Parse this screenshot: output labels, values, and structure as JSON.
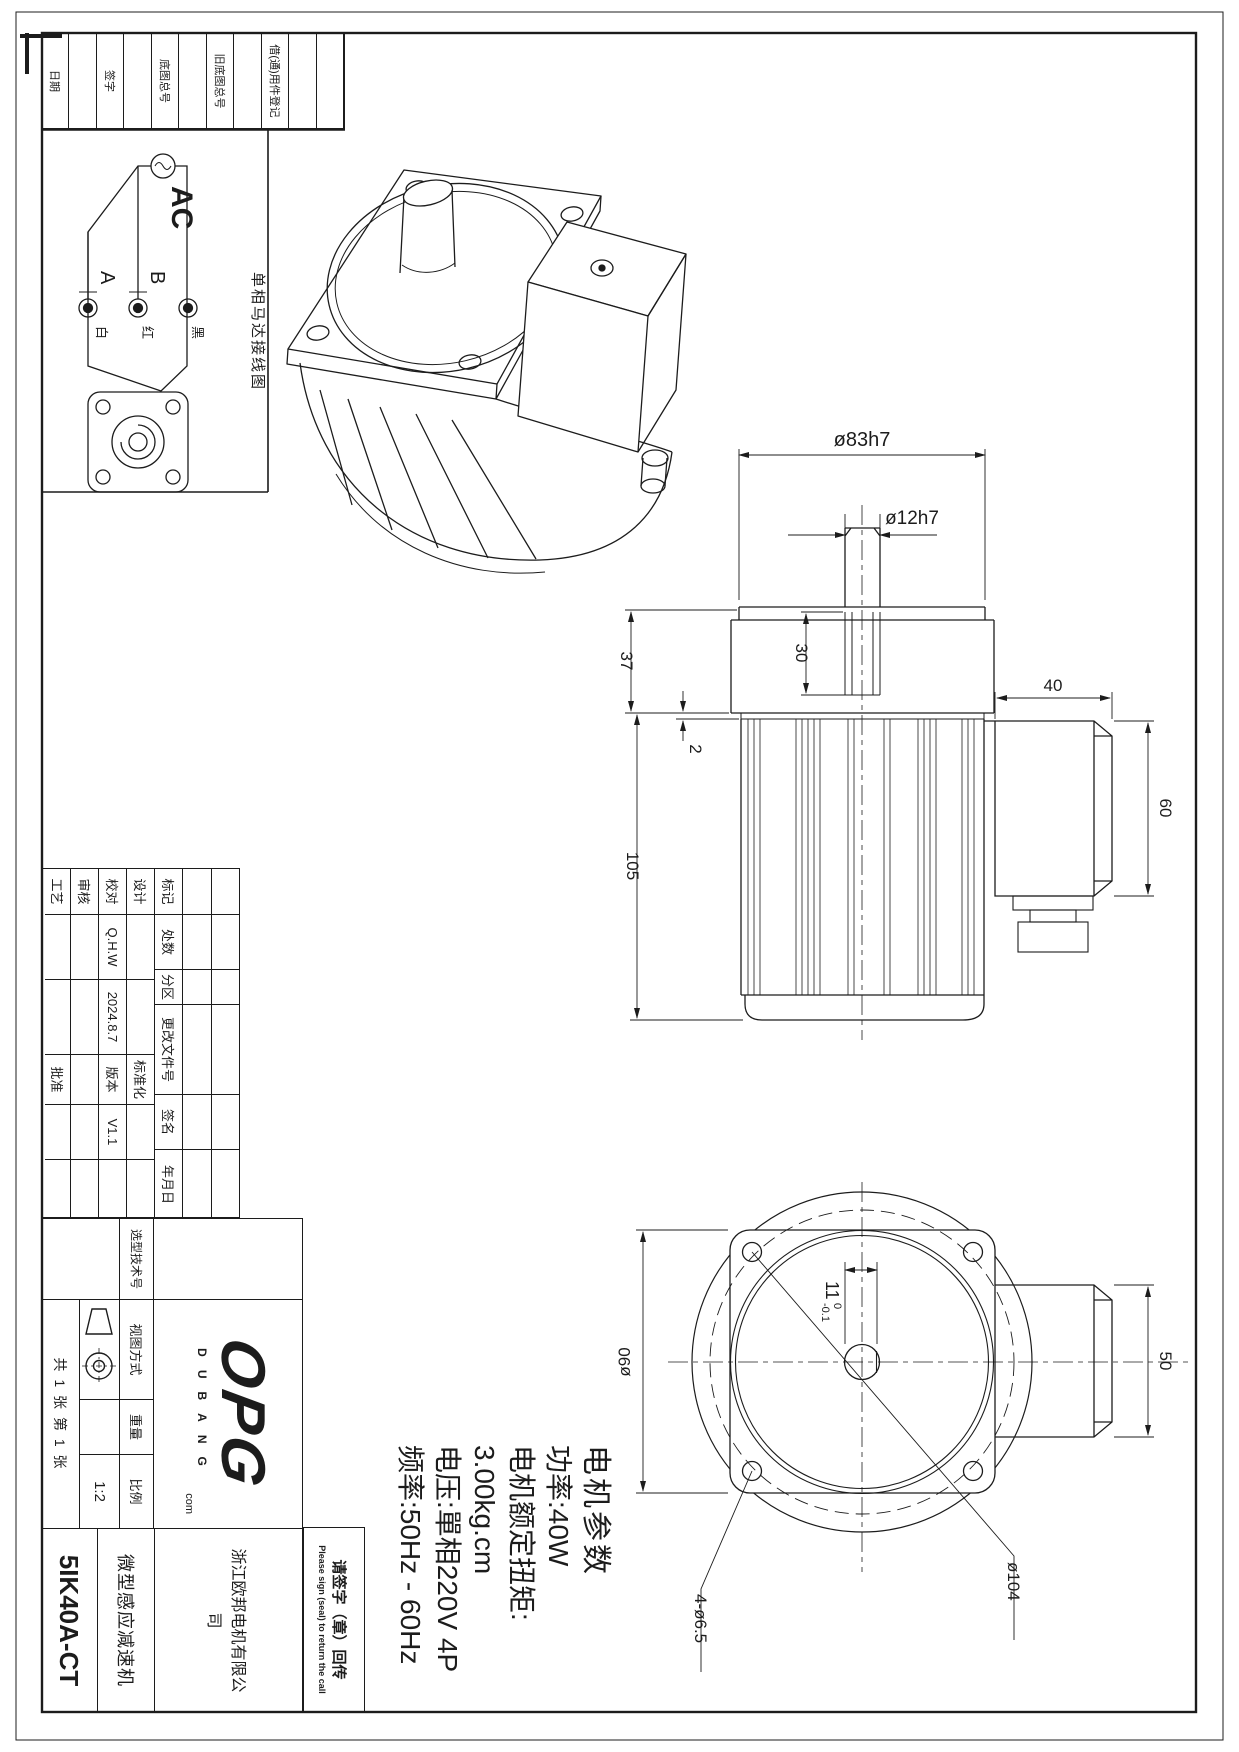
{
  "colors": {
    "line": "#1c1c1c",
    "wiring_label_accent": "#3b3b9e"
  },
  "frame": {
    "strip_labels": [
      "日期",
      "签字",
      "底图总号",
      "旧底图总号",
      "借(通)用件登记"
    ]
  },
  "wiring": {
    "source": "AC",
    "terminal_a": "A",
    "terminal_b": "B",
    "wire_white": "白",
    "wire_red": "红",
    "wire_black": "黑",
    "caption": "单相马达接线图"
  },
  "dimensions": {
    "shaft_boss_dia": "ø83h7",
    "shaft_dia": "ø12h7",
    "shaft_len": "30",
    "gearbox_h": "37",
    "plate_step": "2",
    "body_h": "105",
    "box_w": "40",
    "box_h": "60",
    "flange_dia": "ø90",
    "flat_main": "11",
    "flat_tol_hi": "0",
    "flat_tol_lo": "-0.1",
    "box_w2": "50",
    "bolt_circle": "ø104",
    "holes": "4-ø6.5"
  },
  "params": {
    "title": "电机参数",
    "power": "功率:40W",
    "torque_label": "电机额定扭矩:",
    "torque_value": "3.00kg.cm",
    "voltage": "电压:單相220V 4P",
    "frequency": "频率:50Hz - 60Hz"
  },
  "titleblock": {
    "header": [
      "标记",
      "处数",
      "分区",
      "更改文件号",
      "签名",
      "年月日"
    ],
    "rows": {
      "design": "设计",
      "check": "校对",
      "check_name": "Q.H.W",
      "check_date": "2024.8.7",
      "review": "审核",
      "process": "工艺",
      "standard": "标准化",
      "version_label": "版本",
      "version_value": "V1.1",
      "approve": "批准"
    },
    "selection_no_label": "选型技术号",
    "view_method_label": "视图方式",
    "weight_label": "重量",
    "scale_label": "比例",
    "scale_value": "1:2",
    "sheet_info": "共 1 张 第 1 张",
    "logo_main": "OPG",
    "logo_sub": "DUBANG",
    "logo_com": "com",
    "company": "浙江欧邦电机有限公司",
    "product": "微型感应减速机",
    "part_no": "5IK40A-CT"
  },
  "sign_box": {
    "cn": "请签字（章）回传",
    "en": "Please sign (seal) to return the call"
  }
}
